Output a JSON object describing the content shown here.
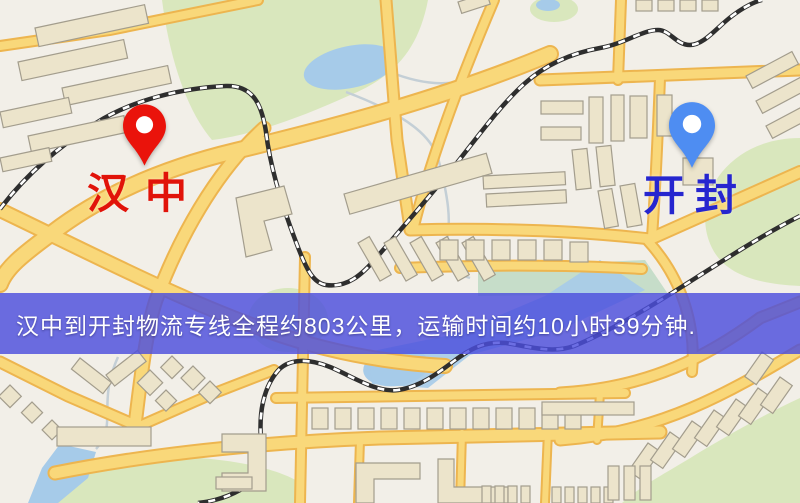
{
  "map": {
    "origin": {
      "label": "汉中",
      "label_color": "#e11309",
      "pin_color": "#ea130b",
      "pin_icon": "map-pin-icon"
    },
    "destination": {
      "label": "开封",
      "label_color": "#2626cf",
      "pin_color": "#4e8df2",
      "pin_icon": "map-pin-icon"
    },
    "info_banner": {
      "text": "汉中到开封物流专线全程约803公里，运输时间约10小时39分钟.",
      "distance_km": "803",
      "duration_hours": "10",
      "duration_minutes": "39",
      "background_color": "#4c4edd",
      "text_color": "#ffffff"
    },
    "theme": {
      "land": "#f2efe8",
      "park": "#d9e7bd",
      "park_teal": "#c6ddc9",
      "water": "#a6cbe9",
      "road_fill": "#f9d87a",
      "road_edge": "#edb54f",
      "railway": "#2e2e2e",
      "building_fill": "#ece4cb",
      "building_stroke": "#a39d8d"
    }
  }
}
